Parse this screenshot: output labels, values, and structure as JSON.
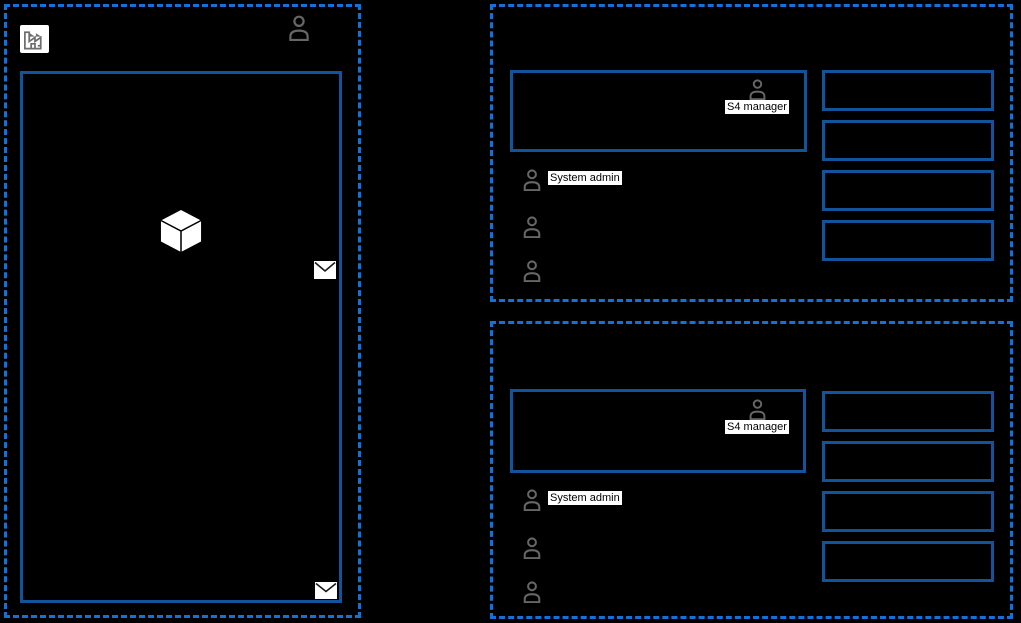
{
  "colors": {
    "background": "#000000",
    "group_border": "#1272dd",
    "box_border": "#11549b",
    "person_icon": "#666666",
    "label_background": "#ffffff",
    "label_text": "#000000",
    "cube_fill": "#ffffff",
    "envelope_fill": "#ffffff"
  },
  "left_group": {
    "factory_icon": "factory-icon",
    "account_icon": "person-icon",
    "package_icon": "cube-icon",
    "mail_icon_right": "envelope-icon",
    "mail_icon_bottom": "envelope-icon"
  },
  "groups": [
    {
      "manager": {
        "icon": "person-icon",
        "label": "S4 manager"
      },
      "members": [
        {
          "icon": "person-icon",
          "label": "System admin"
        },
        {
          "icon": "person-icon",
          "label": ""
        },
        {
          "icon": "person-icon",
          "label": ""
        }
      ],
      "empty_box_count": 4
    },
    {
      "manager": {
        "icon": "person-icon",
        "label": "S4 manager"
      },
      "members": [
        {
          "icon": "person-icon",
          "label": "System admin"
        },
        {
          "icon": "person-icon",
          "label": ""
        },
        {
          "icon": "person-icon",
          "label": ""
        }
      ],
      "empty_box_count": 4
    }
  ]
}
